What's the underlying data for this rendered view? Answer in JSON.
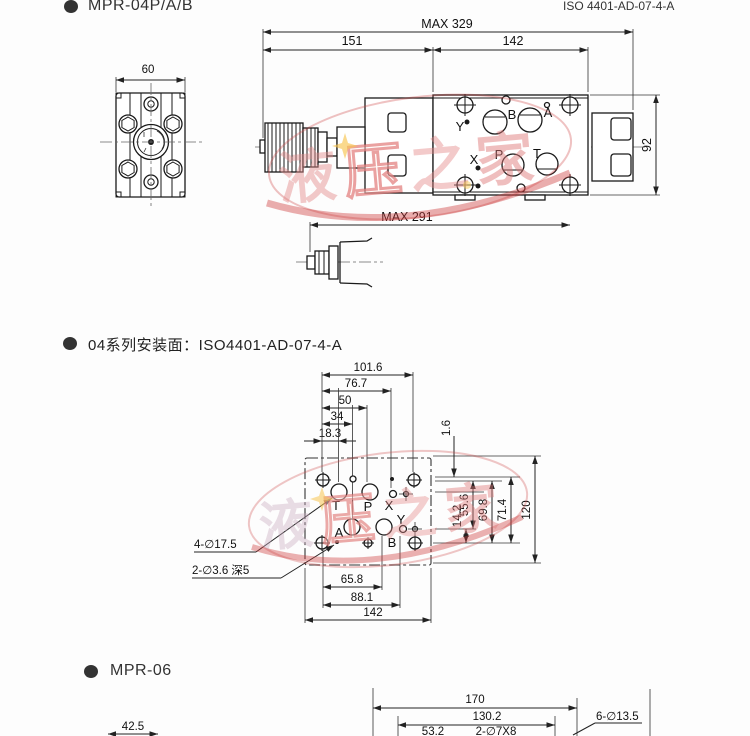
{
  "header": {
    "bullet_title": "MPR-04P/A/B",
    "standard_ref": "ISO 4401-AD-07-4-A"
  },
  "front_view": {
    "dim_width": "60"
  },
  "top_view": {
    "dim_overall": "MAX 329",
    "dim_left": "151",
    "dim_right": "142",
    "dim_height": "92",
    "port_y": "Y",
    "port_b": "B",
    "port_a": "A",
    "port_x": "X",
    "port_p": "P",
    "port_t": "T"
  },
  "side_view": {
    "dim_overall": "MAX 291"
  },
  "mounting_face": {
    "section_title": "04系列安装面：ISO4401-AD-07-4-A",
    "dim_101_6": "101.6",
    "dim_76_7": "76.7",
    "dim_50": "50",
    "dim_34": "34",
    "dim_18_3": "18.3",
    "dim_1_6": "1.6",
    "dim_14_2": "14.2",
    "dim_55_6": "55.6",
    "dim_69_8": "69.8",
    "dim_71_4": "71.4",
    "dim_120": "120",
    "dim_65_8": "65.8",
    "dim_88_1": "88.1",
    "dim_142": "142",
    "label_4_holes": "4-∅17.5",
    "label_2_holes": "2-∅3.6 深5",
    "port_t": "T",
    "port_p": "P",
    "port_x": "X",
    "port_a": "A",
    "port_b": "B",
    "port_y": "Y"
  },
  "mpr06": {
    "section_title": "MPR-06",
    "dim_42_5": "42.5",
    "dim_170": "170",
    "dim_130_2": "130.2",
    "dim_53_2": "53.2",
    "label_2_7x8": "2-∅7X8",
    "label_6_13_5": "6-∅13.5"
  },
  "watermark": {
    "chars": [
      "液",
      "压",
      "之",
      "家"
    ]
  }
}
